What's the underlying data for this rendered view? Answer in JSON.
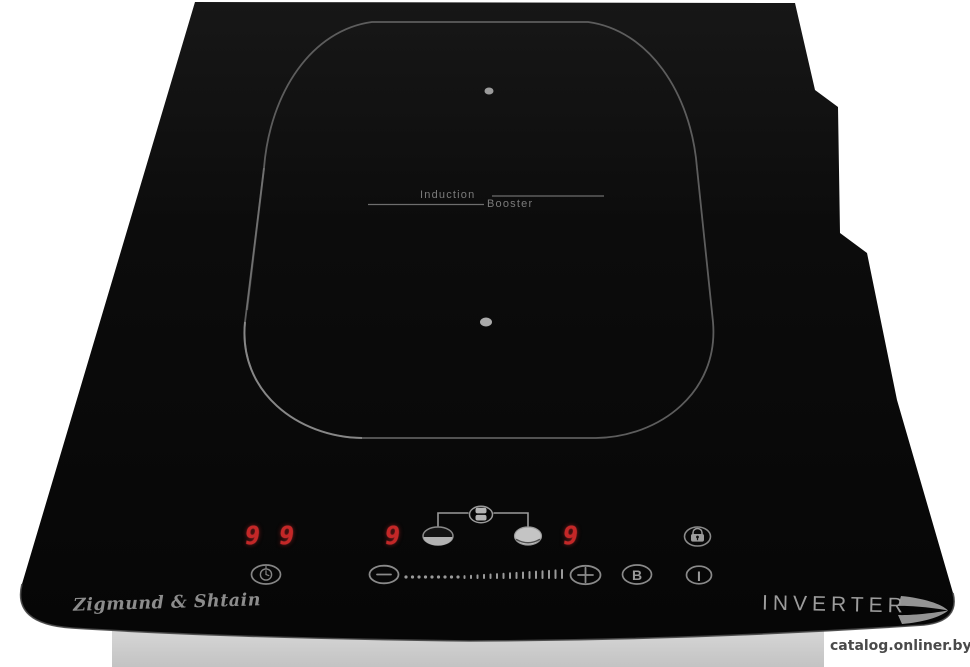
{
  "device": {
    "brand_logo": "Zigmund & Shtain",
    "tech_badge": "INVERTER",
    "zone": {
      "label_top": "Induction",
      "label_bottom": "Booster"
    }
  },
  "display": {
    "timer_value": "99",
    "left_zone_power": "9",
    "right_zone_power": "9"
  },
  "controls": {
    "booster_button": "B",
    "power_button": "I",
    "slider_tick_count": 25
  },
  "watermark": "catalog.onliner.by",
  "colors": {
    "glass": "#0c0c0c",
    "digit_red": "#c42727",
    "etch_gray": "#8f8f8f",
    "base_gray": "#d5d5d5"
  }
}
